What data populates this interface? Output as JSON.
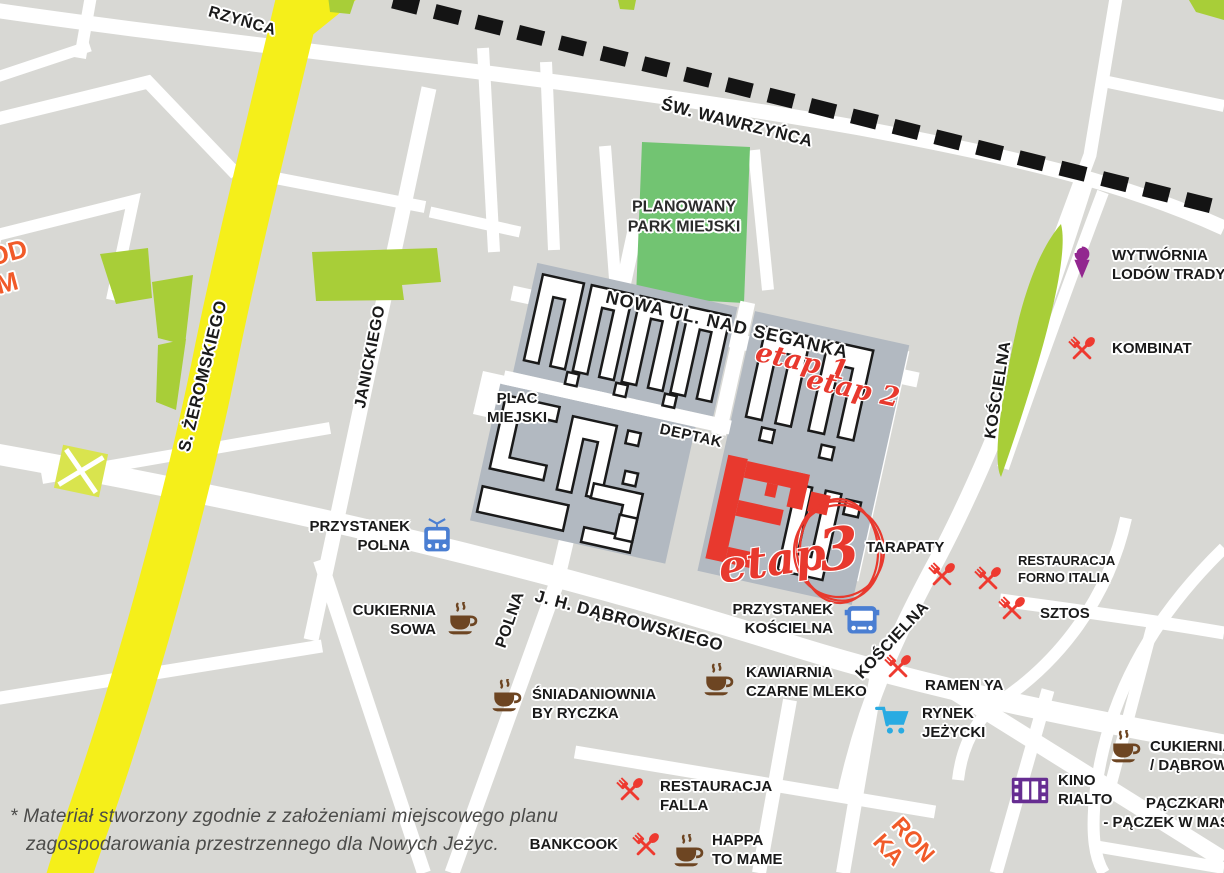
{
  "map_title": "Nowe Jeżyce investment area map",
  "colors": {
    "background": "#d8d8d4",
    "street_white": "#ffffff",
    "main_road_yellow": "#f5ef1a",
    "railway_black": "#141414",
    "park_green": "#72c472",
    "greenery_lime": "#a8ce38",
    "estate_block_gray": "#b2b9c1",
    "stage_red": "#e8392e",
    "poi_red": "#ee3a30",
    "poi_brown": "#6d4522",
    "poi_purple": "#92278f",
    "cinema_purple": "#662d91",
    "transit_blue": "#4a7ed2",
    "cart_blue": "#29abe2",
    "orange_accent": "#f15a29"
  },
  "streets": {
    "sw_wawrzynca": "ŚW. WAWRZYŃCA",
    "wawrzynca_partial": "RZYŃCA",
    "zeromskiego": "S. ŻEROMSKIEGO",
    "janickiego": "JANICKIEGO",
    "polna": "POLNA",
    "dabrowskiego": "J. H. DĄBROWSKIEGO",
    "koscielna_upper": "KOŚCIELNA",
    "koscielna_lower": "KOŚCIELNA",
    "nowa_ul": "NOWA UL. NAD SEGANKĄ",
    "deptak": "DEPTAK"
  },
  "areas": {
    "park": {
      "line1": "PLANOWANY",
      "line2": "PARK MIEJSKI"
    },
    "plac": {
      "line1": "PLAC",
      "line2": "MIEJSKI"
    }
  },
  "stages": {
    "etap1": "etap 1",
    "etap2": "etap 2",
    "etap3_word": "etap",
    "etap3_num": "3"
  },
  "transit": [
    {
      "id": "przystanek-polna",
      "icon": "tram",
      "line1": "PRZYSTANEK",
      "line2": "POLNA"
    },
    {
      "id": "przystanek-koscielna",
      "icon": "bus",
      "line1": "PRZYSTANEK",
      "line2": "KOŚCIELNA"
    }
  ],
  "pois": [
    {
      "id": "cukiernia-sowa",
      "icon": "coffee",
      "line1": "CUKIERNIA",
      "line2": "SOWA"
    },
    {
      "id": "sniadaniownia-by-ryczka",
      "icon": "coffee",
      "line1": "ŚNIADANIOWNIA",
      "line2": "BY RYCZKA"
    },
    {
      "id": "kawiarnia-czarne-mleko",
      "icon": "coffee",
      "line1": "KAWIARNIA",
      "line2": "CZARNE MLEKO"
    },
    {
      "id": "happa-to-mame",
      "icon": "coffee",
      "line1": "HAPPA",
      "line2": "TO MAME"
    },
    {
      "id": "cukiernia-dabrow",
      "icon": "coffee",
      "line1": "CUKIERNIA",
      "line2": "/ DĄBROW"
    },
    {
      "id": "restauracja-falla",
      "icon": "utensils",
      "line1": "RESTAURACJA",
      "line2": "FALLA"
    },
    {
      "id": "bankcook",
      "icon": "utensils",
      "line1": "BANKCOOK"
    },
    {
      "id": "ramen-ya",
      "icon": "utensils",
      "line1": "RAMEN YA"
    },
    {
      "id": "sztos",
      "icon": "utensils",
      "line1": "SZTOS"
    },
    {
      "id": "kombinat",
      "icon": "utensils",
      "line1": "KOMBINAT"
    },
    {
      "id": "tarapaty",
      "icon": "utensils",
      "line1": "TARAPATY"
    },
    {
      "id": "restauracja-forno-italia",
      "icon": "utensils",
      "line1": "RESTAURACJA",
      "line2": "FORNO ITALIA"
    },
    {
      "id": "rynek-jezycki",
      "icon": "cart",
      "line1": "RYNEK",
      "line2": "JEŻYCKI"
    },
    {
      "id": "wytwornia-lodow",
      "icon": "icecream",
      "line1": "WYTWÓRNIA",
      "line2": "LODÓW TRADYC"
    },
    {
      "id": "kino-rialto",
      "icon": "film",
      "line1": "KINO",
      "line2": "RIALTO"
    },
    {
      "id": "paczkarnia",
      "icon": "none",
      "line1": "PĄCZKARN",
      "line2": "- PĄCZEK W MAŚ"
    }
  ],
  "fragments": {
    "topleft_line1": "ÓD",
    "topleft_line2": "M",
    "bottomright_line1": "RON",
    "bottomright_line2": "KA"
  },
  "note": {
    "line1": "* Materiał stworzony zgodnie z założeniami miejscowego planu",
    "line2": "zagospodarowania przestrzennego dla Nowych Jeżyc."
  }
}
